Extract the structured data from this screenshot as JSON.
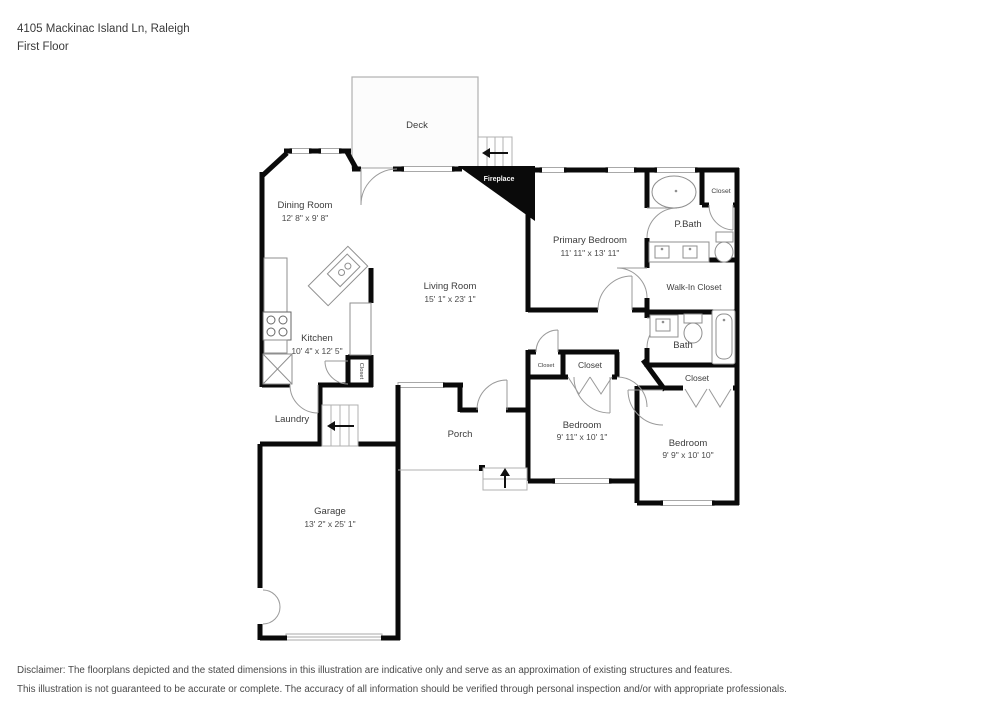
{
  "header": {
    "address": "4105 Mackinac Island Ln, Raleigh",
    "floor": "First Floor"
  },
  "rooms": {
    "deck": {
      "name": "Deck"
    },
    "dining": {
      "name": "Dining Room",
      "dims": "12' 8\" x 9' 8\""
    },
    "living": {
      "name": "Living Room",
      "dims": "15' 1\" x 23' 1\""
    },
    "kitchen": {
      "name": "Kitchen",
      "dims": "10' 4\" x 12' 5\""
    },
    "primary": {
      "name": "Primary Bedroom",
      "dims": "11' 11\" x 13' 11\""
    },
    "pbath": {
      "name": "P.Bath"
    },
    "pbath_closet": {
      "name": "Closet"
    },
    "walkin": {
      "name": "Walk-In Closet"
    },
    "bath": {
      "name": "Bath"
    },
    "hall_closet": {
      "name": "Closet"
    },
    "bedroom1": {
      "name": "Bedroom",
      "dims": "9' 11\" x 10' 1\""
    },
    "bedroom2": {
      "name": "Bedroom",
      "dims": "9' 9\" x 10' 10\""
    },
    "closet_small": {
      "name": "Closet"
    },
    "closet_big": {
      "name": "Closet"
    },
    "kitchen_closet": {
      "name": "Closet"
    },
    "laundry": {
      "name": "Laundry"
    },
    "porch": {
      "name": "Porch"
    },
    "garage": {
      "name": "Garage",
      "dims": "13' 2\" x 25' 1\""
    },
    "fireplace": {
      "name": "Fireplace"
    }
  },
  "disclaimer": {
    "line1": "Disclaimer: The floorplans depicted and the stated dimensions in this illustration are indicative only and serve as an approximation of existing structures and features.",
    "line2": "This illustration is not guaranteed to be accurate or complete. The accuracy of all information should be verified through personal inspection and/or with appropriate professionals."
  },
  "colors": {
    "wall": "#0a0a0a",
    "thin_line": "#9a9a9a",
    "text": "#3c3c3c"
  }
}
